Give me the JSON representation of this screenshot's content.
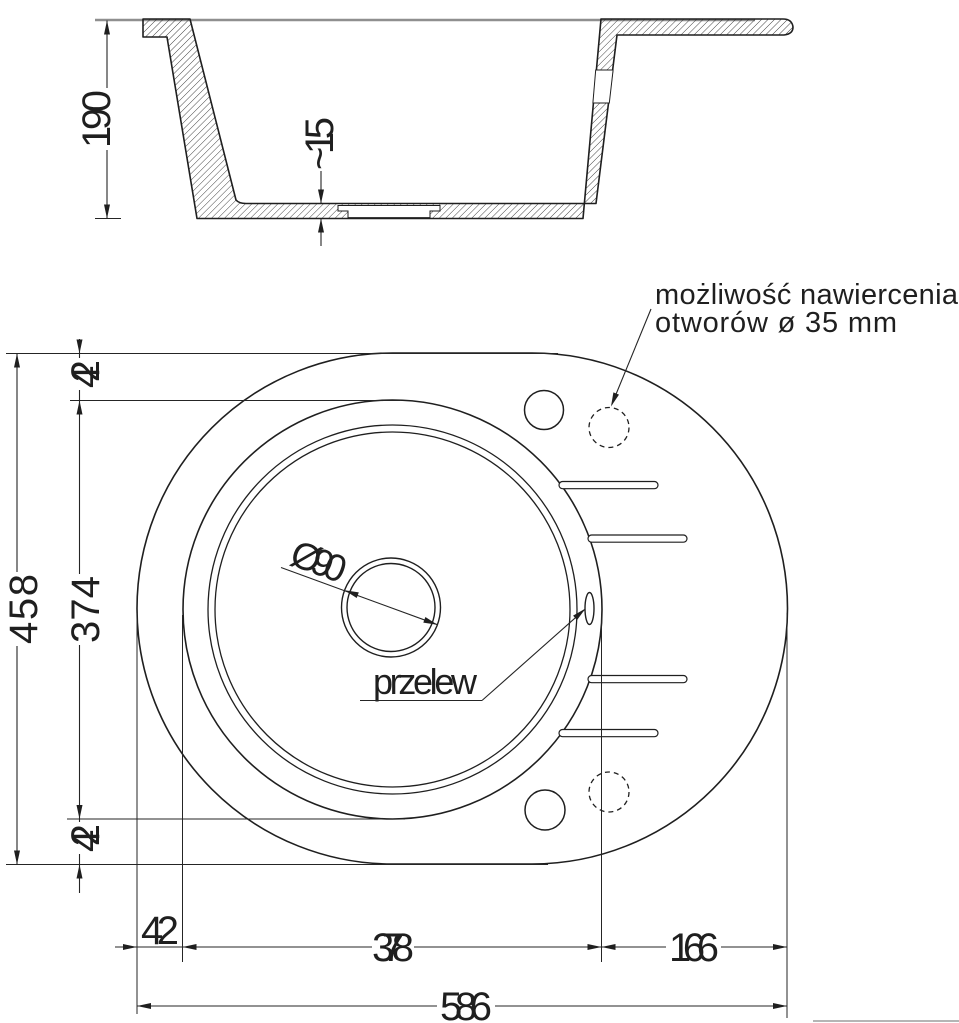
{
  "drawing": {
    "type": "technical-drawing-kitchen-sink",
    "section_view": {
      "depth_label": "190",
      "bottom_thickness_label": "~15"
    },
    "plan_view": {
      "drain_diameter_label": "Ø90",
      "overflow_label": "przelew",
      "note_line1": "możliwość nawiercenia",
      "note_line2": "otworów ø 35 mm"
    },
    "dimensions_left": {
      "total_height": "458",
      "top_offset": "42",
      "bowl_height": "374",
      "bottom_offset": "42"
    },
    "dimensions_bottom": {
      "left_offset": "42",
      "bowl_width": "378",
      "drainer_width": "166",
      "total_width": "586"
    },
    "colors": {
      "line": "#1f1f1f",
      "dimension": "#252525",
      "countertop": "#8f8f8f",
      "corner_rule": "#b5b5b5",
      "background": "#ffffff"
    }
  }
}
